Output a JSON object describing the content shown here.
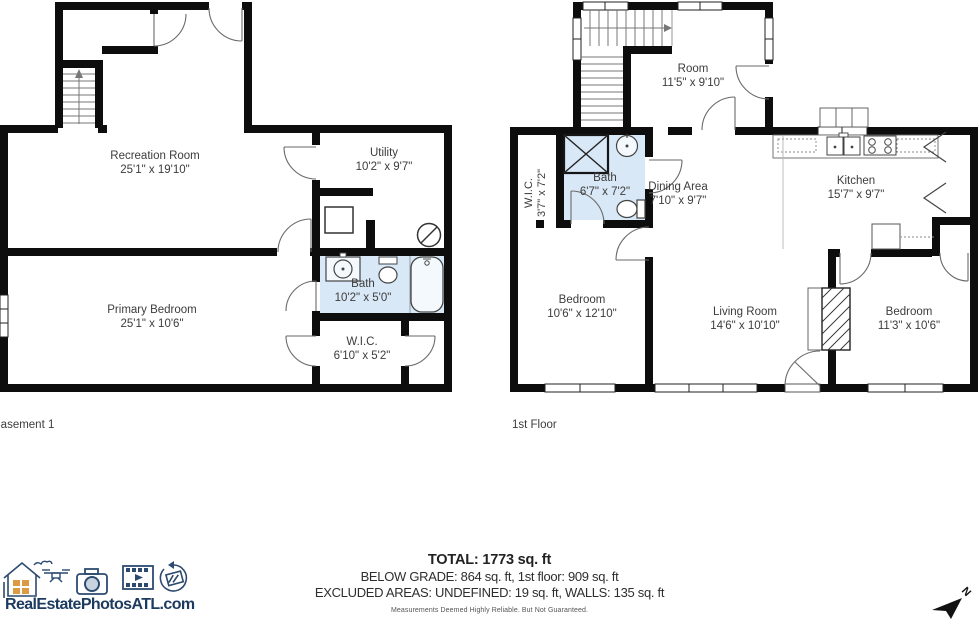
{
  "plans": {
    "basement": {
      "label": "Basement 1",
      "rooms": [
        {
          "name": "Recreation Room",
          "dims": "25'1\" x 19'10\""
        },
        {
          "name": "Utility",
          "dims": "10'2\" x 9'7\""
        },
        {
          "name": "Primary Bedroom",
          "dims": "25'1\" x 10'6\""
        },
        {
          "name": "Bath",
          "dims": "10'2\" x 5'0\""
        },
        {
          "name": "W.I.C.",
          "dims": "6'10\" x 5'2\""
        }
      ]
    },
    "first": {
      "label": "1st Floor",
      "rooms": [
        {
          "name": "Room",
          "dims": "11'5\" x 9'10\""
        },
        {
          "name": "W.I.C.",
          "dims": "3'7\" x 7'2\""
        },
        {
          "name": "Bath",
          "dims": "6'7\" x 7'2\""
        },
        {
          "name": "Dining Area",
          "dims": "7'10\" x 9'7\""
        },
        {
          "name": "Kitchen",
          "dims": "15'7\" x 9'7\""
        },
        {
          "name": "Bedroom",
          "dims": "10'6\" x 12'10\""
        },
        {
          "name": "Living Room",
          "dims": "14'6\" x 10'10\""
        },
        {
          "name": "Bedroom",
          "dims": "11'3\" x 10'6\""
        }
      ]
    }
  },
  "summary": {
    "total": "TOTAL: 1773 sq. ft",
    "below_grade_line": "BELOW GRADE: 864 sq. ft, 1st floor: 909 sq. ft",
    "excluded_line": "EXCLUDED AREAS: UNDEFINED: 19 sq. ft, WALLS: 135 sq. ft",
    "disclaimer": "Measurements Deemed Highly Reliable. But Not Guaranteed."
  },
  "branding": {
    "logo_text": "RealEstatePhotosATL.com",
    "icons": [
      "house-icon",
      "drone-icon",
      "camera-icon",
      "video-film-icon",
      "360-tour-icon"
    ]
  },
  "compass": {
    "label": "N"
  },
  "colors": {
    "wall": "#0d0d0d",
    "bath_fill": "#d8e8f6",
    "logo_navy": "#1d3a5f",
    "logo_orange": "#dd9a45",
    "label_text": "#3c3c3c"
  }
}
